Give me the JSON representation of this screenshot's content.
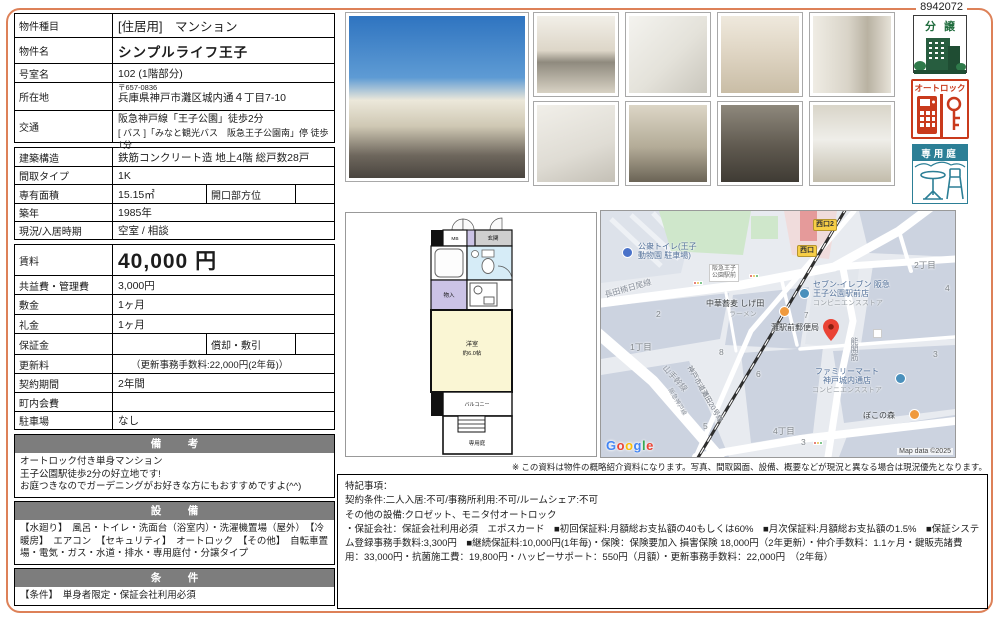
{
  "serial": "8942072",
  "colors": {
    "frame_accent": "#dd8158",
    "section_bar": "#7d7d7d",
    "badge_green": "#275d3f",
    "badge_red": "#c93a1c",
    "badge_teal": "#2c7f96",
    "rent_text": "#1c1c1c"
  },
  "listing": {
    "type_label": "物件種目",
    "type_value": "[住居用]　マンション",
    "name_label": "物件名",
    "name_value": "シンプルライフ王子",
    "room_label": "号室名",
    "room_value": "102 (1階部分)",
    "addr_label": "所在地",
    "addr_postal": "〒657-0836",
    "addr_value": "兵庫県神戸市灘区城内通４丁目7-10",
    "access_label": "交通",
    "access_line1": "阪急神戸線「王子公園」徒歩2分",
    "access_line2": "[ バス ]「みなと観光バス　阪急王子公園南」停 徒歩1分",
    "structure_label": "建築構造",
    "structure_value": "鉄筋コンクリート造 地上4階 総戸数28戸",
    "layout_label": "間取タイプ",
    "layout_value": "1K",
    "area_label": "専有面積",
    "area_value": "15.15㎡",
    "opening_label": "開口部方位",
    "opening_value": "",
    "built_label": "築年",
    "built_value": "1985年",
    "status_label": "現況/入居時期",
    "status_value": "空室 / 相談",
    "rent_label": "賃料",
    "rent_value": "40,000 円",
    "fee_label": "共益費・管理費",
    "fee_value": "3,000円",
    "deposit_label": "敷金",
    "deposit_value": "1ヶ月",
    "keymoney_label": "礼金",
    "keymoney_value": "1ヶ月",
    "guarantee_label": "保証金",
    "guarantee_value": "",
    "amortization_label": "償却・敷引",
    "amortization_value": "",
    "renewal_label": "更新料",
    "renewal_value": "（更新事務手数料:22,000円(2年毎)）",
    "term_label": "契約期間",
    "term_value": "2年間",
    "association_label": "町内会費",
    "association_value": "",
    "parking_label": "駐車場",
    "parking_value": "なし"
  },
  "biko": {
    "header": "備　考",
    "line1": "オートロック付き単身マンション",
    "line2": "王子公園駅徒歩2分の好立地です!",
    "line3": "お庭つきなのでガーデニングがお好きな方にもおすすめですよ(^^)"
  },
  "setsubi": {
    "header": "設　備",
    "text": "【水廻り】　風呂・トイレ・洗面台（浴室内）・洗濯機置場（屋外）　【冷暖房】　エアコン　【セキュリティ】　オートロック　【その他】　自転車置場・電気・ガス・水道・排水・専用庭付・分譲タイプ"
  },
  "joken": {
    "header": "条　件",
    "text": "【条件】　単身者限定・保証会社利用必須"
  },
  "badges": {
    "bunjo": "分譲",
    "autolock": "オートロック",
    "garden": "専用庭"
  },
  "floorplan": {
    "mb": "MB",
    "entrance": "玄関",
    "closet": "物入",
    "room_name": "洋室",
    "room_size": "約6.0帖",
    "balcony": "バルコニー",
    "garden": "専用庭"
  },
  "map": {
    "toilet_line1": "公衆トイレ(王子",
    "toilet_line2": "動物園 駐車場)",
    "road_nagata": "長田楠日尾線",
    "busstop_line1": "阪急王子",
    "busstop_line2": "公園駅前",
    "exit2": "西口2",
    "exit": "西口",
    "seven_line1": "セブン-イレブン 阪急",
    "seven_line2": "王子公園駅前店",
    "seven_sub": "コンビニエンスストア",
    "ramen": "中華蕎麦 しげ田",
    "ramen_sub": "ラーメン",
    "postoffice": "灘駅前郵便局",
    "road_nokaku": "能閣筋",
    "chome2": "2丁目",
    "chome1": "1丁目",
    "chome4": "4丁目",
    "road_yamate": "山手幹線",
    "rail_hankyu": "阪急神戸線",
    "road_city": "神戸市道灘田20号線",
    "familymart_line1": "ファミリーマート",
    "familymart_line2": "神戸城内通店",
    "familymart_sub": "コンビニエンスストア",
    "pokonomori": "ぼこの森",
    "n2": "2",
    "n7": "7",
    "n8": "8",
    "n6": "6",
    "n5": "5",
    "n3a": "3",
    "n3b": "3",
    "n4": "4",
    "google_letters": [
      "G",
      "o",
      "o",
      "g",
      "l",
      "e"
    ],
    "attribution": "Map data ©2025"
  },
  "disclaimer": "※ この資料は物件の概略紹介資料になります。写真、間取図面、設備、概要などが現況と異なる場合は現況優先となります。",
  "notes": {
    "line1": "特記事項：",
    "line2": "契約条件:二人入居:不可/事務所利用:不可/ルームシェア:不可",
    "line3": "その他の設備:クロゼット、モニタ付オートロック",
    "line4": "・保証会社：保証会社利用必須　エポスカード　■初回保証料:月額総お支払額の40もしくは60%　■月次保証料:月額総お支払額の1.5%　■保証システム登録事務手数料:3,300円　■継続保証料:10,000円(1年毎)・保険：保険要加入 損害保険 18,000円（2年更新）・仲介手数料：1.1ヶ月・鍵販売諸費用：33,000円・抗菌施工費：19,800円・ハッピーサポート：550円（月額）・更新事務手数料：22,000円　（2年毎）"
  }
}
